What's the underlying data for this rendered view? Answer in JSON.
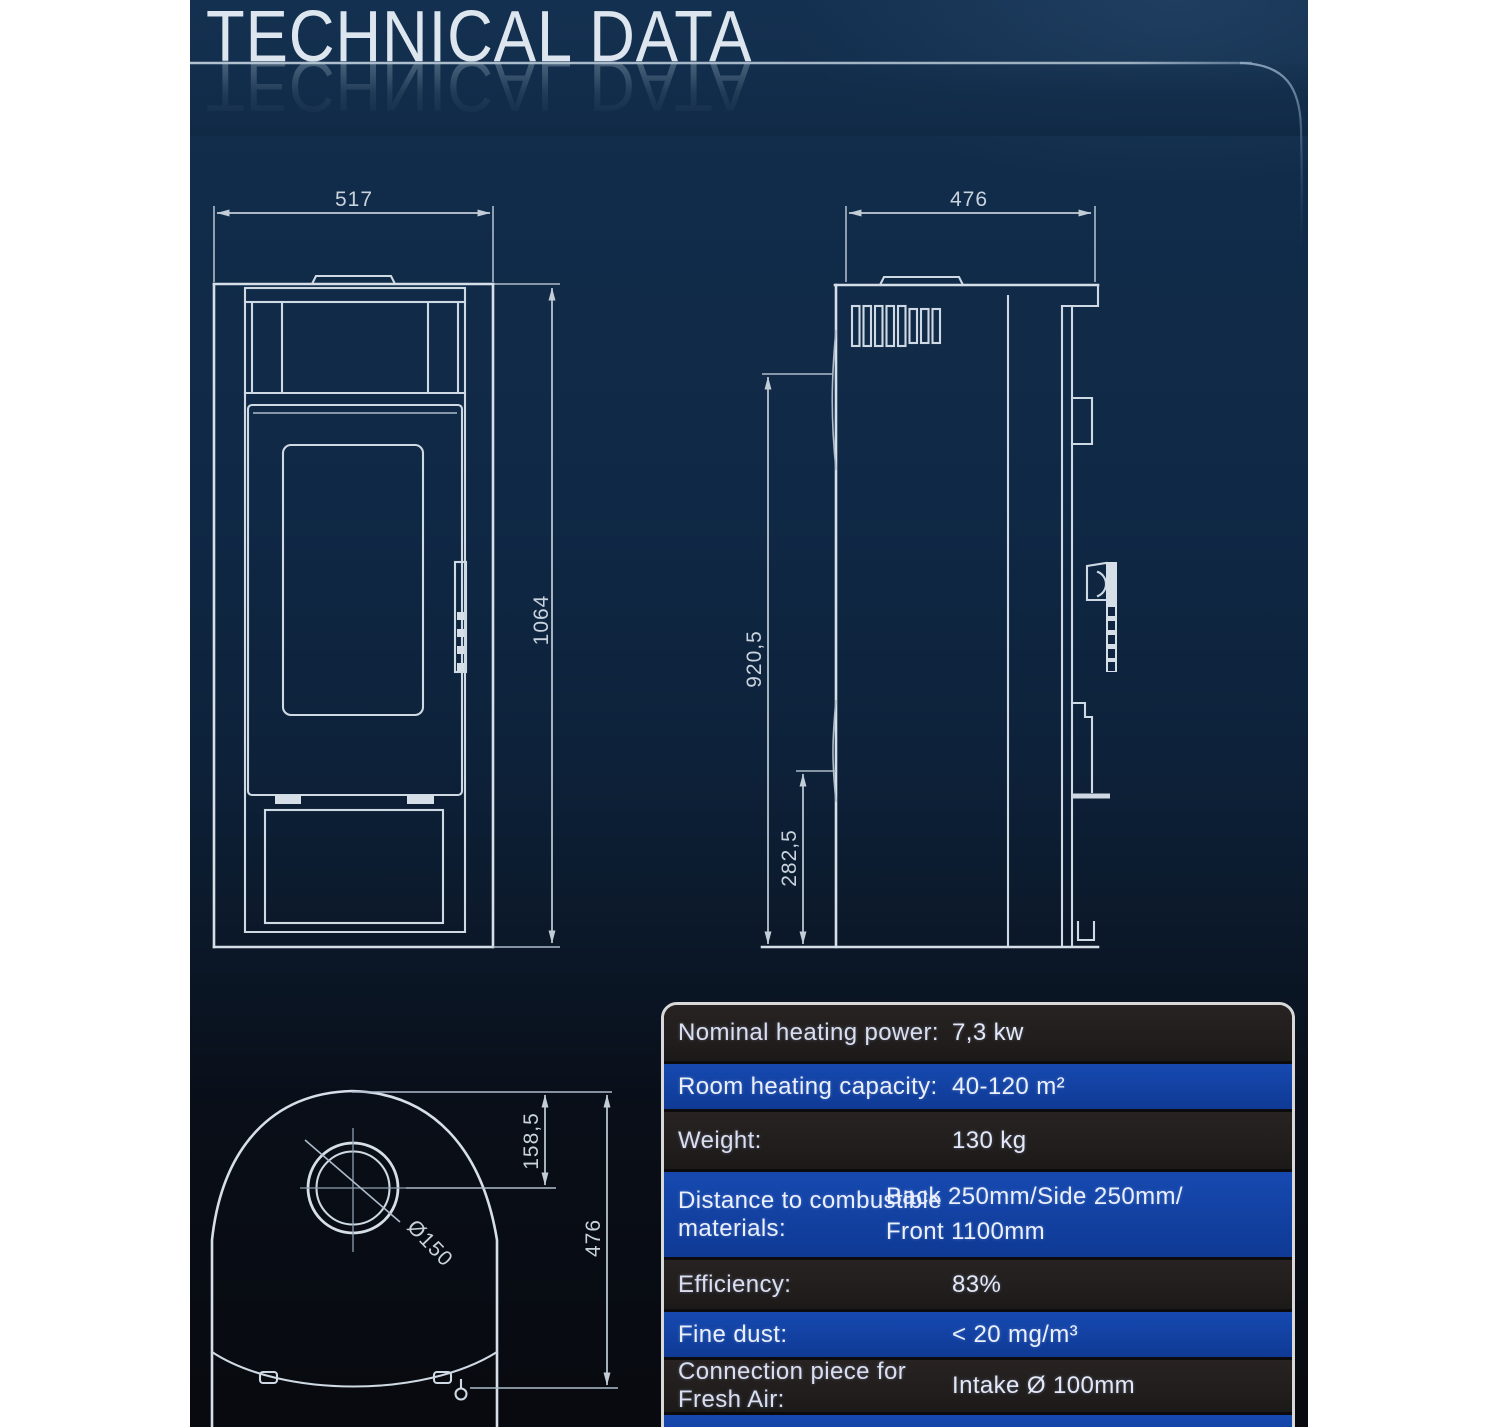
{
  "page": {
    "title": "TECHNICAL DATA"
  },
  "table": {
    "rows": [
      {
        "label": "Nominal heating power:",
        "value": "7,3 kw"
      },
      {
        "label": "Room heating capacity:",
        "value": "40-120 m²"
      },
      {
        "label": "Weight:",
        "value": "130 kg"
      },
      {
        "label": "Distance to combustible materials:",
        "value": "Back 250mm/Side 250mm/\nFront 1100mm"
      },
      {
        "label": "Efficiency:",
        "value": "83%"
      },
      {
        "label": "Fine dust:",
        "value": "< 20 mg/m³"
      },
      {
        "label": "Connection piece for Fresh Air:",
        "value": "Intake Ø 100mm"
      },
      {
        "label": "",
        "value": ""
      }
    ]
  },
  "drawings": {
    "front_view": {
      "width": "517",
      "height": "1064"
    },
    "side_view": {
      "depth": "476",
      "height_total": "920,5",
      "height_lower": "282,5"
    },
    "top_view": {
      "flue_offset": "158,5",
      "depth": "476",
      "flue_diameter": "Ø150"
    }
  },
  "colors": {
    "background_top": "#143050",
    "background_bottom": "#080a0f",
    "table_blue_row": "#1243a6",
    "table_dark_row": "#242020",
    "table_border": "#d8d8d8",
    "drawing_line": "#d6dfe8",
    "title_text": "#dde6ee"
  }
}
